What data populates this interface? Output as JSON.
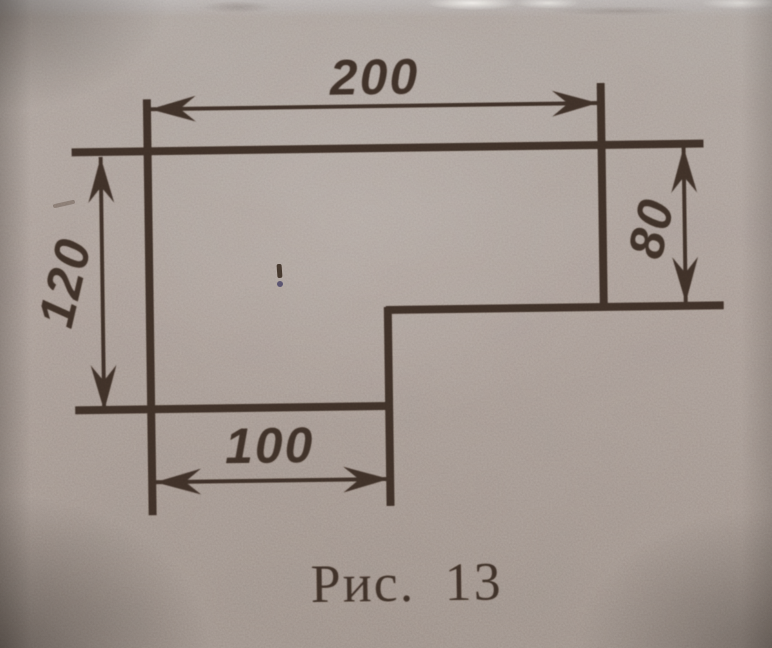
{
  "figure": {
    "caption": "Рис. 13",
    "description": "L-shaped plate outline with four dimension arrows",
    "dimensions": [
      {
        "name": "top-width",
        "value": "200"
      },
      {
        "name": "left-height",
        "value": "120"
      },
      {
        "name": "right-height",
        "value": "80"
      },
      {
        "name": "bottom-width",
        "value": "100"
      }
    ],
    "colors": {
      "ink": "#3b2e27",
      "paper": "#a89c96"
    }
  }
}
